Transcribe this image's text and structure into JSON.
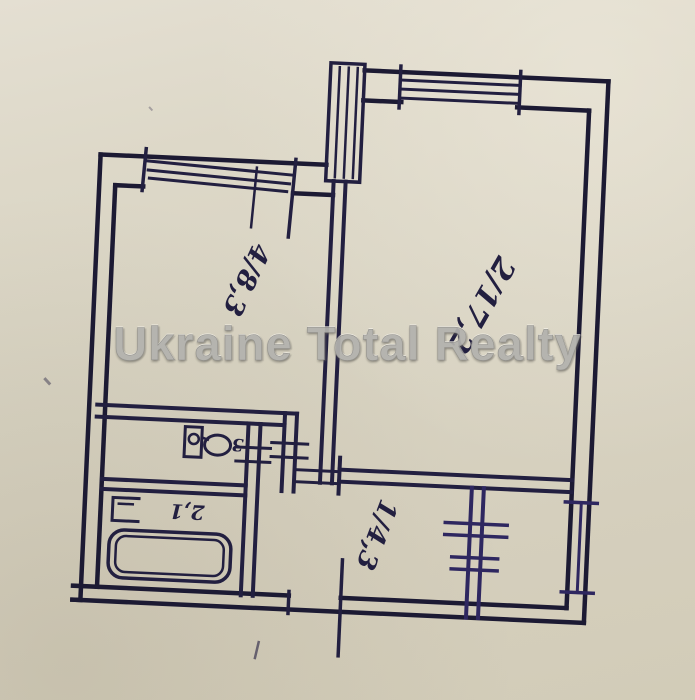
{
  "watermark": {
    "text": "Ukraine Total Realty"
  },
  "plan": {
    "type": "apartment floor plan (hand-drawn, scanned photo)",
    "labels": {
      "room_large": "2/17,2",
      "room_small": "4/8,3",
      "hallway": "1/4,3",
      "bathroom": "2,1",
      "wc": "3"
    },
    "rooms": [
      {
        "name": "living-room",
        "label": "2/17,2",
        "area": "17,2"
      },
      {
        "name": "bedroom",
        "label": "4/8,3",
        "area": "8,3"
      },
      {
        "name": "hallway",
        "label": "1/4,3",
        "area": "4,3"
      },
      {
        "name": "bathroom",
        "label": "2,1",
        "area": "2,1"
      },
      {
        "name": "wc",
        "label": "3",
        "area": "3"
      },
      {
        "name": "kitchen",
        "label": ""
      }
    ],
    "colors": {
      "ink": "#221f40",
      "ink_dark": "#1c1a33",
      "ink_purple": "#2e2760",
      "paper": "#d9d4c3",
      "watermark": "#b3b2ae"
    }
  }
}
